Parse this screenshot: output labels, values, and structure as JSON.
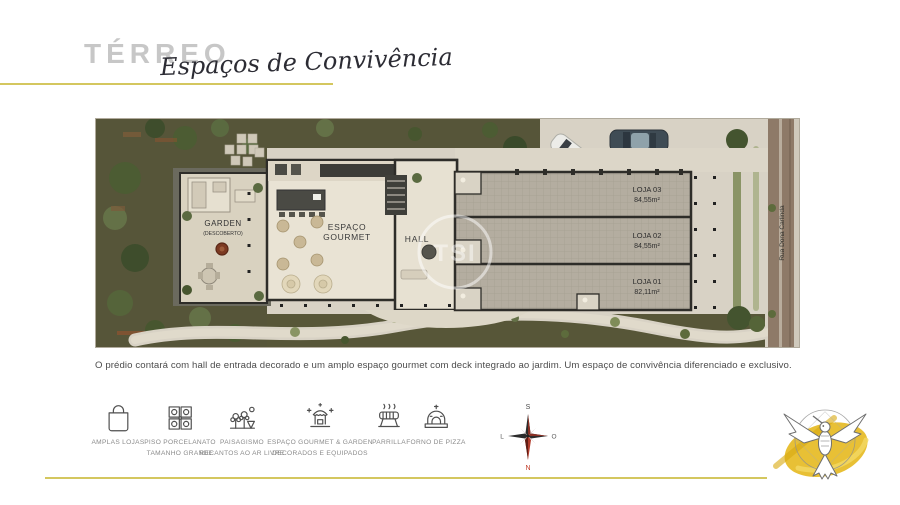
{
  "header": {
    "title": "TÉRREO",
    "subtitle": "Espaços de Convivência"
  },
  "plan": {
    "garden_label": "GARDEN",
    "garden_sublabel": "(DESCOBERTO)",
    "gourmet_label_line1": "ESPAÇO",
    "gourmet_label_line2": "GOURMET",
    "hall_label": "HALL",
    "street_name": "Rua Dona Carlinda",
    "watermark": "TSI",
    "lojas": [
      {
        "name": "LOJA 03",
        "area": "84,55m²"
      },
      {
        "name": "LOJA 02",
        "area": "84,55m²"
      },
      {
        "name": "LOJA 01",
        "area": "82,11m²"
      }
    ]
  },
  "description": "O prédio contará com hall de entrada decorado e um amplo espaço gourmet com deck integrado ao jardim. Um espaço de convivência diferenciado e exclusivo.",
  "features": [
    {
      "icon": "shopping-bag-icon",
      "label1": "AMPLAS LOJAS",
      "label2": ""
    },
    {
      "icon": "tile-icon",
      "label1": "PISO PORCELANATO",
      "label2": "TAMANHO GRANDE"
    },
    {
      "icon": "landscaping-icon",
      "label1": "PAISAGISMO",
      "label2": "RECANTOS AO AR LIVRE"
    },
    {
      "icon": "gourmet-garden-icon",
      "label1": "ESPAÇO GOURMET & GARDEN",
      "label2": "DECORADOS E EQUIPADOS"
    },
    {
      "icon": "grill-icon",
      "label1": "PARRILLA",
      "label2": ""
    },
    {
      "icon": "pizza-oven-icon",
      "label1": "FORNO DE PIZZA",
      "label2": ""
    }
  ],
  "compass": {
    "top": "S",
    "left": "L",
    "right": "O",
    "bottom": "N"
  },
  "colors": {
    "accent_gold": "#d4c75f",
    "title_gray": "#c7c7c7",
    "garden_green": "#565539",
    "pavement": "#d8d2c5",
    "street_brown": "#8e7a68",
    "logo_gold": "#e6b91f"
  }
}
